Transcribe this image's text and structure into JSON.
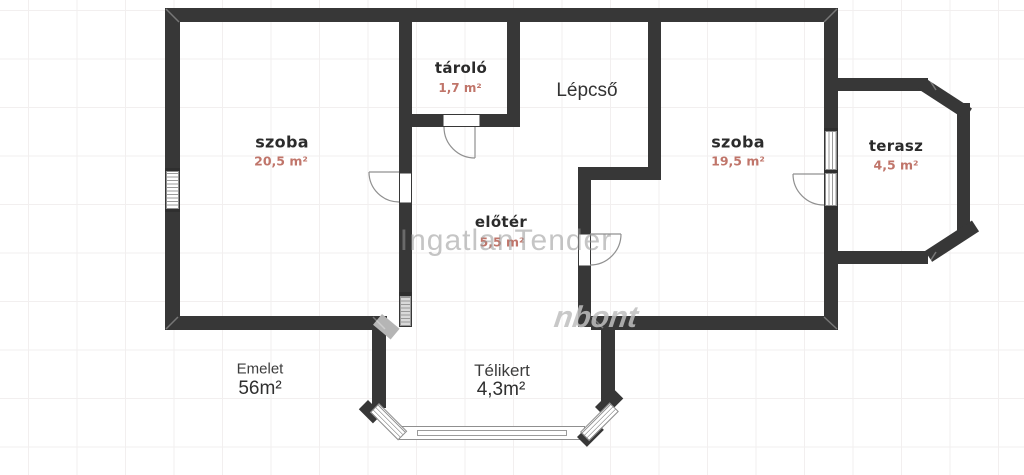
{
  "floorplan": {
    "watermark": "IngatlanTender",
    "watermark_partial": "nbont",
    "rooms": [
      {
        "name": "szoba",
        "area": "20,5 m²"
      },
      {
        "name": "tároló",
        "area": "1,7 m²"
      },
      {
        "name": "szoba",
        "area": "19,5 m²"
      },
      {
        "name": "terasz",
        "area": "4,5 m²"
      },
      {
        "name": "előtér",
        "area": "5,5 m²"
      }
    ],
    "labels": {
      "staircase": "Lépcső",
      "level": "Emelet",
      "level_area": "56m²",
      "wintergarden": "Télikert",
      "wintergarden_area": "4,3m²"
    },
    "colors": {
      "wall": "#373737",
      "room_text": "#2b2b2b",
      "area_text": "#c0756a",
      "secondary_text": "#3d3d3d",
      "watermark": "#9b9b9b",
      "grid": "#f2efef"
    }
  }
}
